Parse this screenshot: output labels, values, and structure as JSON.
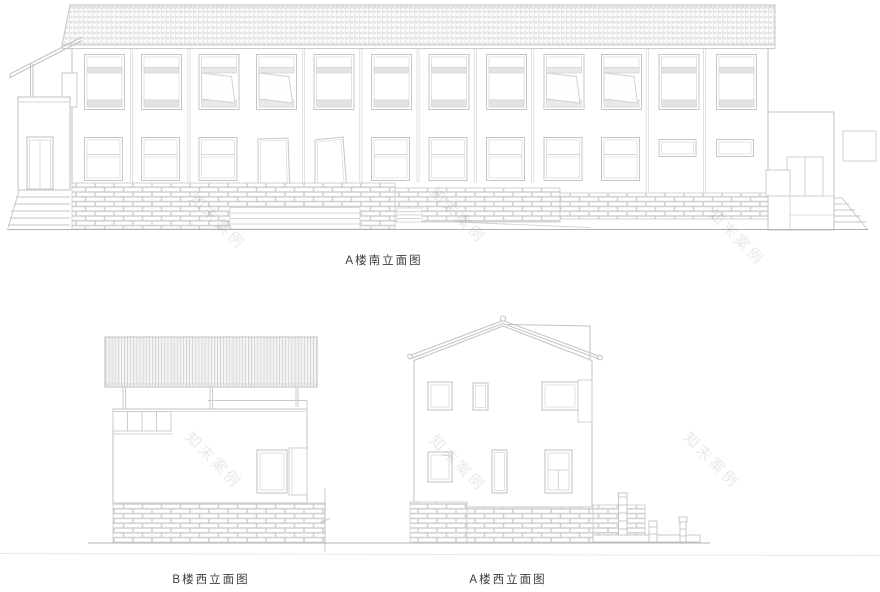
{
  "sheet": {
    "title_visible_text_only": true
  },
  "figures": [
    {
      "id": "a-south",
      "label": "A楼南立面图"
    },
    {
      "id": "b-west",
      "label": "B楼西立面图"
    },
    {
      "id": "a-west",
      "label": "A楼西立面图"
    }
  ],
  "watermark": {
    "text": "知末案例"
  },
  "colors": {
    "background": "#ffffff",
    "line": "#bdbdbd",
    "line_fine": "#d6d6d6",
    "fill_band": "#e3e3e3",
    "text": "#3d3d3d",
    "watermark": "rgba(80,80,80,0.13)"
  }
}
